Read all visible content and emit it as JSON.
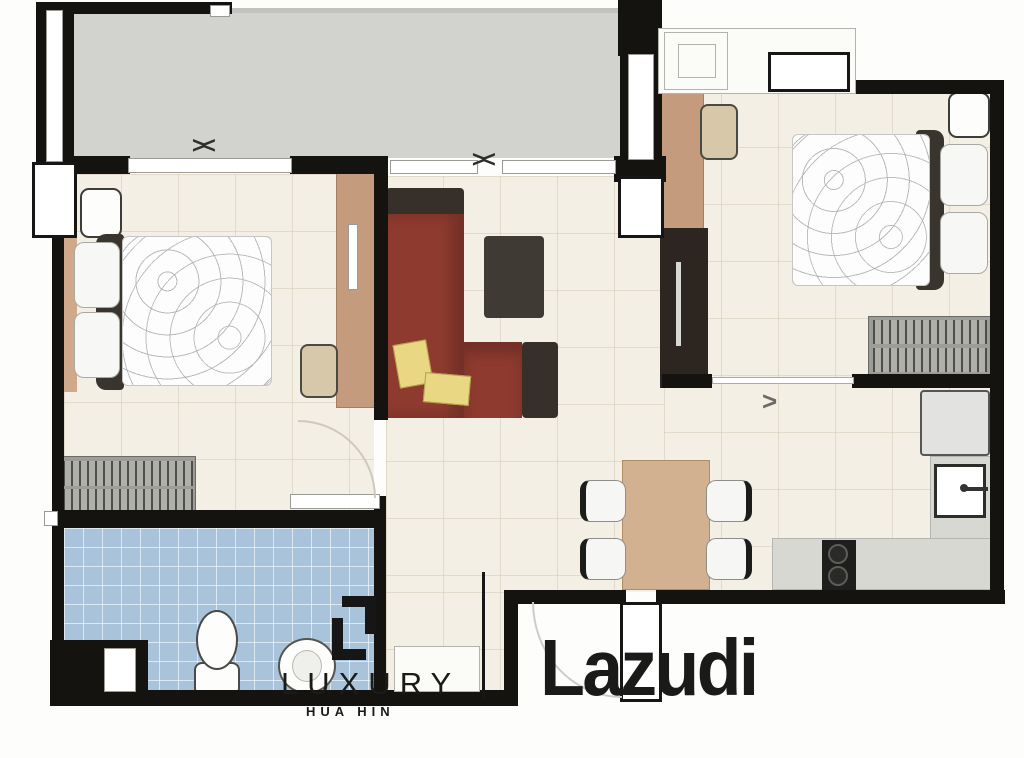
{
  "watermark": {
    "brand": "Lazudi",
    "agency_name": "LUXURY",
    "agency_location": "HUA HIN"
  },
  "symbols": {
    "sliding_door": "><",
    "door_swing": ">"
  },
  "colors": {
    "wall": "#151310",
    "balcony_floor": "#d2d2cf",
    "interior_floor": "#f4efe5",
    "bathroom_floor": "#a9c3da",
    "sofa_red": "#8e3a2f",
    "sofa_dark": "#37302a",
    "cushion_yellow": "#e9d783",
    "wood_light": "#c49b7c",
    "table_wood": "#d2b190",
    "cabinet_dark": "#2c2520",
    "counter_gray": "#d8d8d3",
    "wardrobe_gray": "#9c9c98"
  }
}
